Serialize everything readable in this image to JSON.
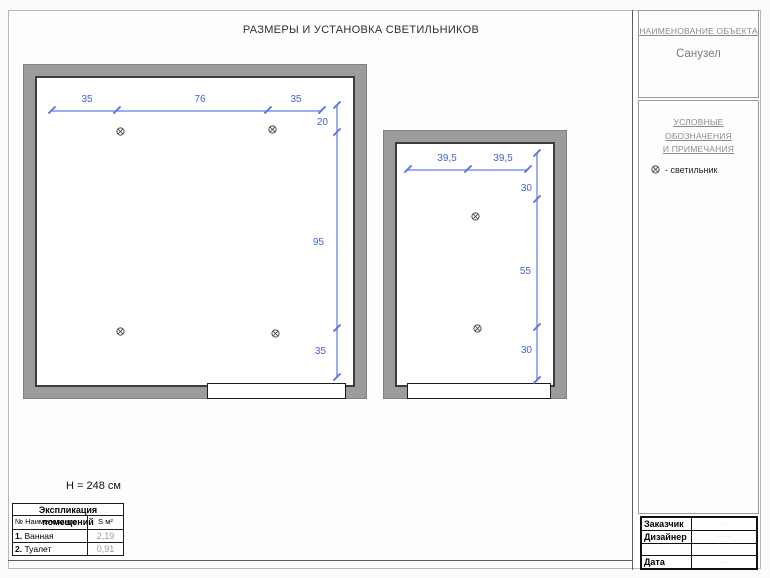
{
  "sheet": {
    "title": "РАЗМЕРЫ И УСТАНОВКА СВЕТИЛЬНИКОВ",
    "ceiling_height": "Н = 248 см"
  },
  "dims": {
    "bath_top": [
      "35",
      "76",
      "35"
    ],
    "bath_right": [
      "20",
      "95",
      "35"
    ],
    "toilet_top": [
      "39,5",
      "39,5"
    ],
    "toilet_right": [
      "30",
      "55",
      "30"
    ]
  },
  "explication": {
    "title": "Экспликация помещений",
    "header": {
      "name": "№ Наименование",
      "area": "S м²"
    },
    "rows": [
      {
        "num": "1.",
        "name": "Ванная",
        "area": "2,19"
      },
      {
        "num": "2.",
        "name": "Туалет",
        "area": "0,91"
      }
    ]
  },
  "panel": {
    "object_heading": "НАИМЕНОВАНИЕ ОБЪЕКТА",
    "object_name": "Санузел",
    "legend_heading_line1": "УСЛОВНЫЕ ОБОЗНАЧЕНИЯ",
    "legend_heading_line2": "И ПРИМЕЧАНИЯ",
    "legend_item_label": "- светильник",
    "titleblock": {
      "rows": [
        {
          "label": "Заказчик",
          "value": "··"
        },
        {
          "label": "Дизайнер",
          "value": "··  ··"
        },
        {
          "label": "",
          "value": ""
        },
        {
          "label": "Дата",
          "value": "· ··"
        }
      ]
    }
  },
  "colors": {
    "dimension_line": "#9bb0ec",
    "dimension_text": "#4464cf",
    "wall_fill": "#9c9c9c",
    "wall_edge": "#3d3d3d",
    "panel_heading_text": "#8a8a8a"
  }
}
